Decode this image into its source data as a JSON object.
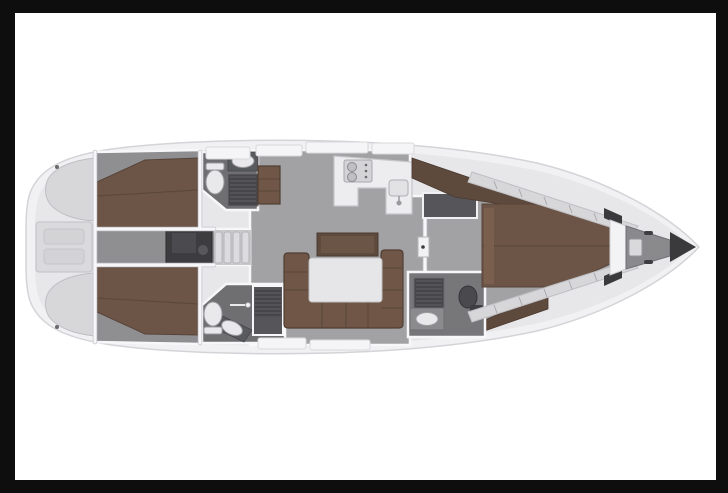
{
  "figure": {
    "type": "yacht-interior-floor-plan",
    "orientation": "bow-right",
    "description": "Top-down rendered deck layout of a sailing yacht interior on a white canvas with black frame; no visible text labels"
  },
  "colors": {
    "background": "#0e0e0e",
    "canvas": "#ffffff",
    "hull": "#f1f1f3",
    "hull_line": "#d4d4d8",
    "deck": "#e7e7ea",
    "floor": "#a2a2a4",
    "floor_dark": "#8f8f92",
    "head_floor": "#6f6f72",
    "berth": "#6c5546",
    "berth_seam": "#594638",
    "settee": "#705646",
    "wardrobe": "#5e493d",
    "counter": "#ededef",
    "table": "#e6e6e8",
    "engine": "#3d3d40",
    "grate": "#47474a",
    "fixture": "#e9e9eb",
    "dark_trim": "#3a3a3d",
    "wall": "#f7f7f9",
    "wall_edge": "#c6c6ca"
  },
  "rooms": [
    {
      "name": "stern-lazarette"
    },
    {
      "name": "aft-cabin-port"
    },
    {
      "name": "aft-cabin-starboard"
    },
    {
      "name": "companionway-engine-room"
    },
    {
      "name": "head-aft-port"
    },
    {
      "name": "head-aft-starboard"
    },
    {
      "name": "salon-with-u-settee-and-table"
    },
    {
      "name": "galley"
    },
    {
      "name": "forward-head"
    },
    {
      "name": "forward-owner-cabin-island-berth"
    },
    {
      "name": "anchor-locker-bow"
    }
  ]
}
